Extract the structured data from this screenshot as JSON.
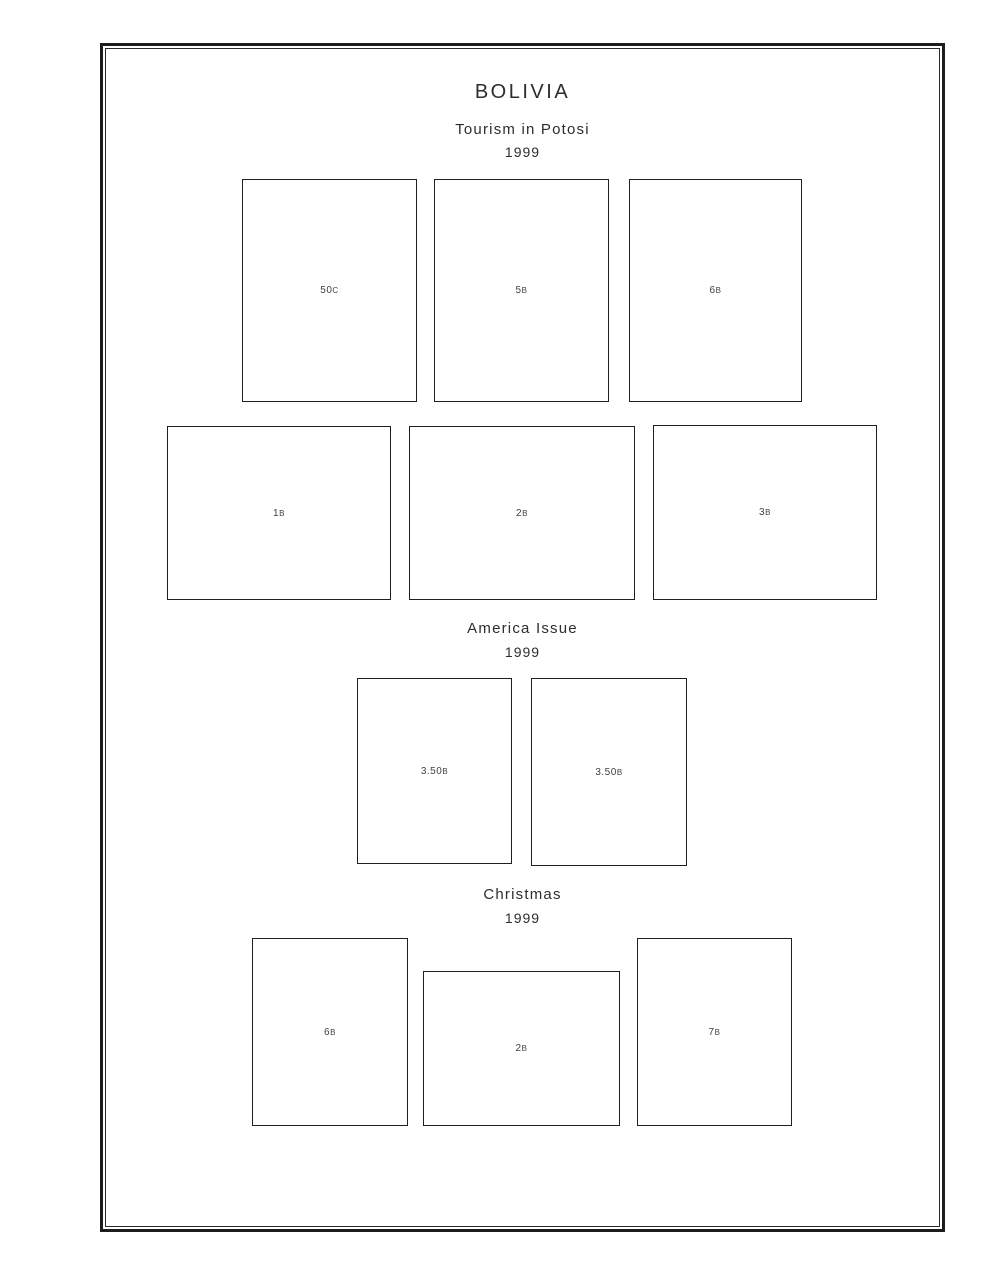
{
  "page": {
    "country_title": "BOLIVIA",
    "sections": [
      {
        "heading": "Tourism in Potosi",
        "year": "1999",
        "stamps": [
          {
            "value": "50",
            "unit": "C"
          },
          {
            "value": "5",
            "unit": "B"
          },
          {
            "value": "6",
            "unit": "B"
          },
          {
            "value": "1",
            "unit": "B"
          },
          {
            "value": "2",
            "unit": "B"
          },
          {
            "value": "3",
            "unit": "B"
          }
        ]
      },
      {
        "heading": "America Issue",
        "year": "1999",
        "stamps": [
          {
            "value": "3.50",
            "unit": "B"
          },
          {
            "value": "3.50",
            "unit": "B"
          }
        ]
      },
      {
        "heading": "Christmas",
        "year": "1999",
        "stamps": [
          {
            "value": "6",
            "unit": "B"
          },
          {
            "value": "2",
            "unit": "B"
          },
          {
            "value": "7",
            "unit": "B"
          }
        ]
      }
    ],
    "colors": {
      "outer_border": "#1c1c1c",
      "inner_border": "#2a2a2a",
      "box_border": "#1f1f1f",
      "heading_text": "#2d2d2d",
      "label_text": "#3f3f3f",
      "background": "#ffffff"
    }
  }
}
